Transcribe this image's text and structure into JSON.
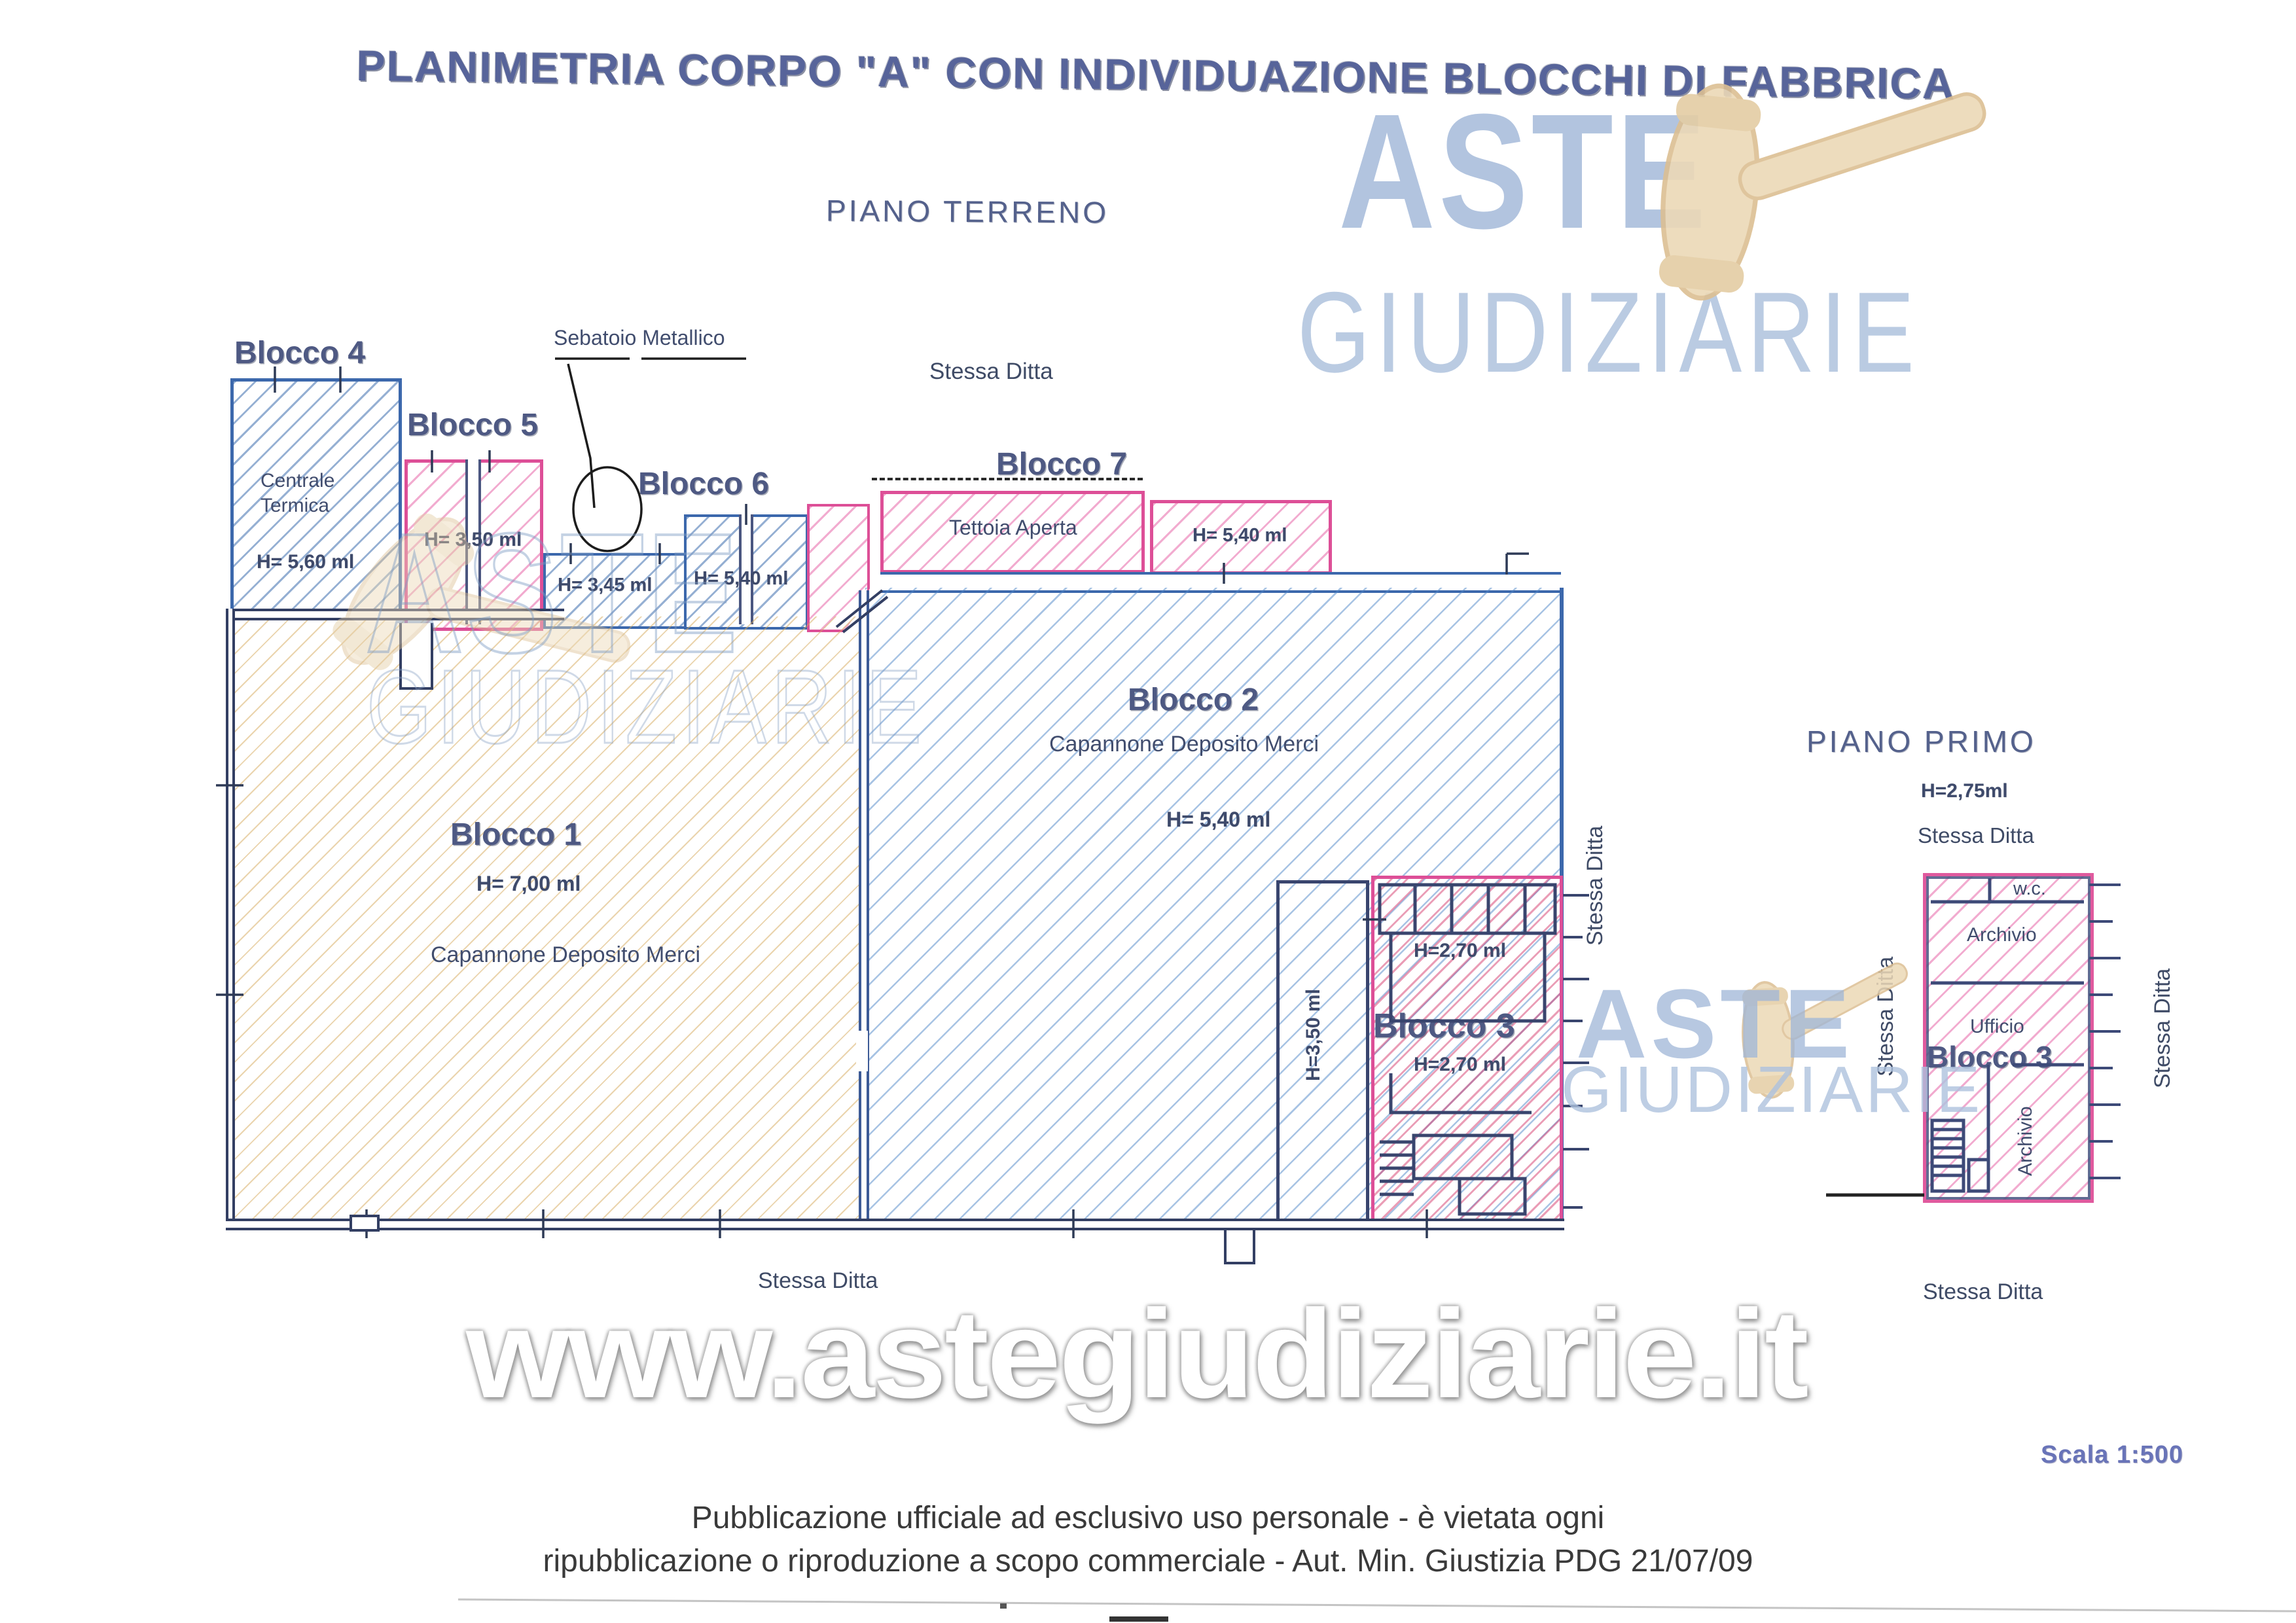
{
  "header": {
    "title": "PLANIMETRIA CORPO \"A\" CON INDIVIDUAZIONE BLOCCHI DI FABBRICA",
    "ground_floor_label": "PIANO TERRENO",
    "first_floor_label": "PIANO PRIMO"
  },
  "logo": {
    "line1": "ASTE",
    "line2": "GIUDIZIARIE"
  },
  "watermark": {
    "url": "www.astegiudiziarie.it"
  },
  "blocks": {
    "b1": {
      "label": "Blocco 1",
      "height": "H= 7,00 ml",
      "description": "Capannone Deposito Merci"
    },
    "b2": {
      "label": "Blocco 2",
      "height": "H= 5,40 ml",
      "description": "Capannone Deposito Merci",
      "inner_room_height": "H=3,50 ml"
    },
    "b3": {
      "label": "Blocco 3",
      "height_upper": "H=2,70 ml",
      "height_lower": "H=2,70 ml"
    },
    "b4": {
      "label": "Blocco 4",
      "room": "Centrale Termica",
      "height": "H= 5,60 ml"
    },
    "b5": {
      "label": "Blocco 5",
      "height": "H= 3,50 ml"
    },
    "b6": {
      "label": "Blocco 6",
      "height": "H= 5,40 ml",
      "strip_height": "H= 3,45 ml"
    },
    "b7": {
      "label": "Blocco 7",
      "room": "Tettoia Aperta",
      "height": "H= 5,40 ml"
    }
  },
  "annotations": {
    "tank": "Sebatoio Metallico",
    "same_company": "Stessa Ditta"
  },
  "first_floor": {
    "height": "H=2,75ml",
    "block_label": "Blocco 3",
    "rooms": {
      "wc": "w.c.",
      "archive_top": "Archivio",
      "office": "Ufficio",
      "archive_side": "Archivio"
    }
  },
  "footer": {
    "scale": "Scala 1:500",
    "line1": "Pubblicazione ufficiale ad esclusivo uso personale - è vietata ogni",
    "line2": "ripubblicazione o riproduzione a scopo commerciale - Aut. Min. Giustizia PDG 21/07/09"
  },
  "colors": {
    "wall_blue": "#3c68ac",
    "wall_pink": "#dd4f97",
    "wall_dark": "#333f63",
    "hatch_yellow": "#d6aa5c",
    "hatch_red": "#d63c6e",
    "label_blue": "#4e5983",
    "logo_blue": "#9fb6d8",
    "gavel_tan": "#ecd9b6",
    "scala_blue": "#6974b8"
  }
}
